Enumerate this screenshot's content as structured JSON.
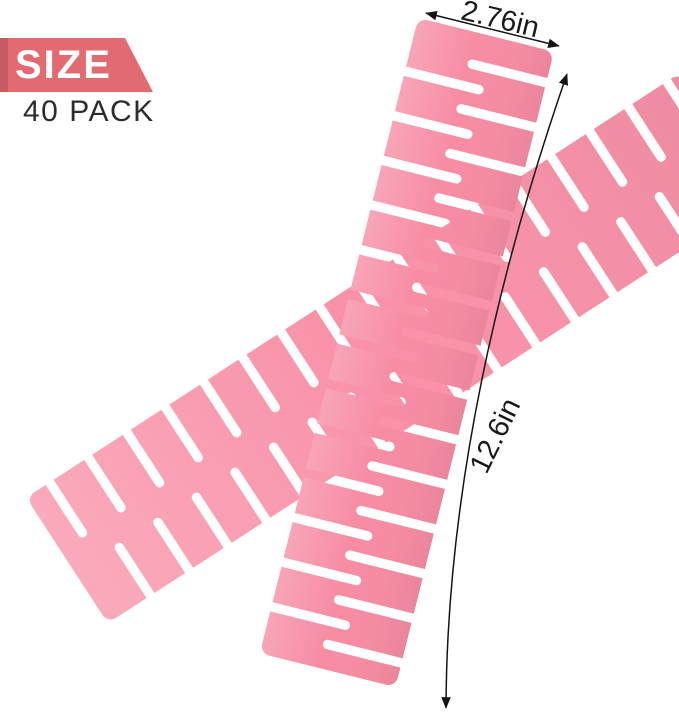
{
  "badge": {
    "size_label": "SIZE",
    "pack_label": "40 PACK",
    "ribbon_color": "#e16b71",
    "ribbon_fold_color": "#c75b63",
    "size_text_color": "#ffffff",
    "pack_text_color": "#2c2c2c"
  },
  "dimensions": {
    "width": {
      "label": "2.76in"
    },
    "length": {
      "label": "12.6in"
    },
    "line_color": "#141414",
    "label_color": "#1a1a1a"
  },
  "product": {
    "front_divider_color": "#f78ca3",
    "back_divider_color": "#f992a8"
  }
}
